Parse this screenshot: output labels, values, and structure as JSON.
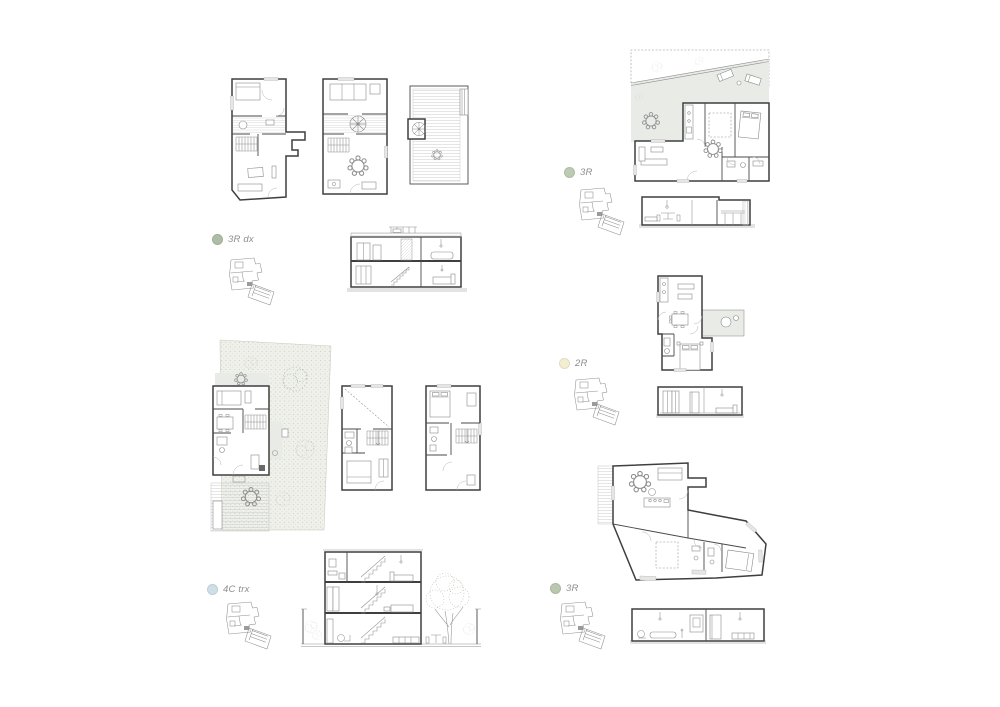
{
  "sheet": {
    "background": "#ffffff",
    "units": [
      {
        "id": "unit-3r-dx",
        "label": "3R dx",
        "dot_color": "#aebda4"
      },
      {
        "id": "unit-4c-trx",
        "label": "4C trx",
        "dot_color": "#cfdfe7"
      },
      {
        "id": "unit-3r-top",
        "label": "3R",
        "dot_color": "#bccbb1"
      },
      {
        "id": "unit-2r",
        "label": "2R",
        "dot_color": "#f3eed0"
      },
      {
        "id": "unit-3r-bottom",
        "label": "3R",
        "dot_color": "#b9c8ae"
      }
    ]
  }
}
